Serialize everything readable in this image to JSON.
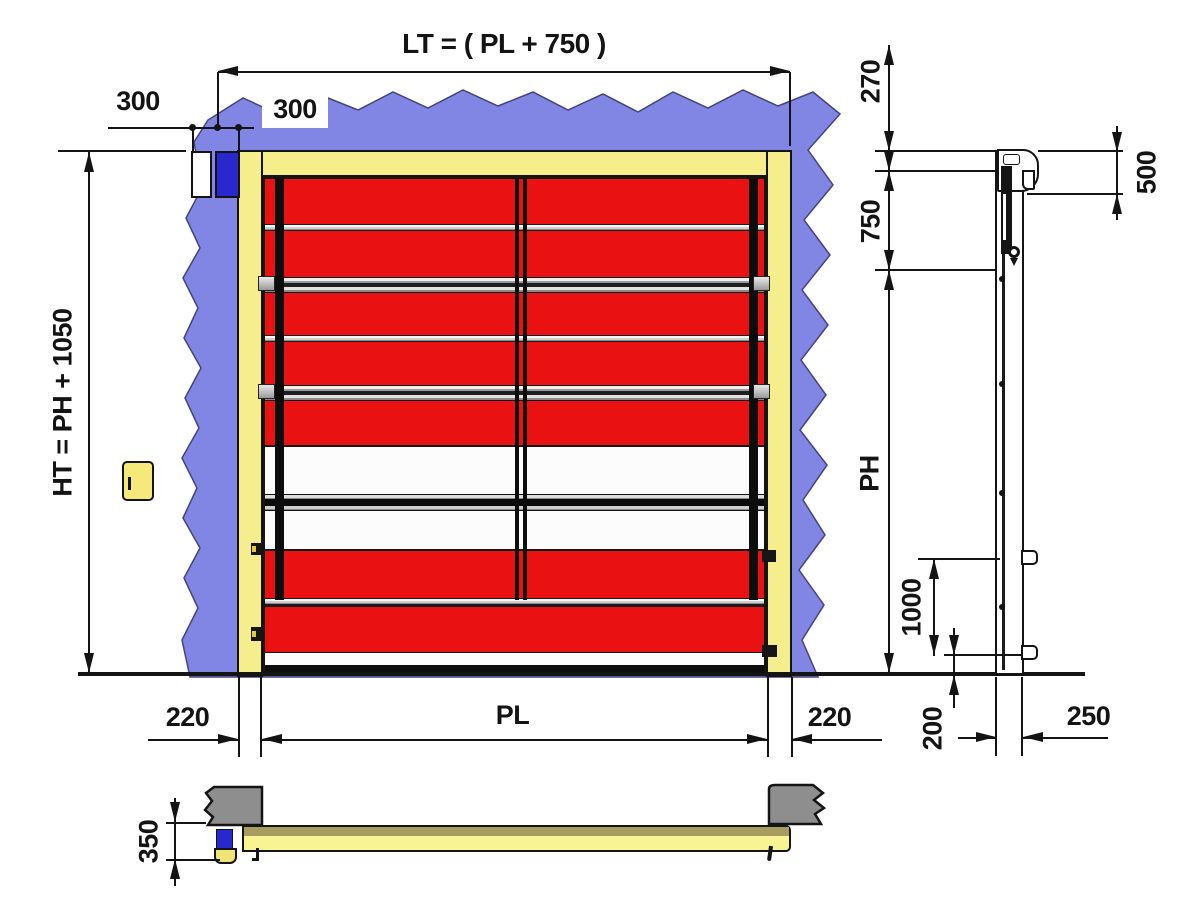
{
  "drawing": {
    "type": "technical-drawing",
    "views": {
      "front": "front elevation",
      "side": "side profile",
      "section": "bottom plan section"
    }
  },
  "colors": {
    "wall_blue": "#8186E4",
    "frame_yellow": "#F6EE8D",
    "curtain_red": "#E91111",
    "motor_blue": "#2828CC",
    "masonry_gray": "#8E8E8E",
    "metal_silver": "#C9C9C9",
    "section_bar_top": "#A89D60",
    "section_bar_body": "#F8F494",
    "line": "#141414"
  },
  "front": {
    "lt": "LT = ( PL + 750 )",
    "w300_left": "300",
    "w300_right": "300",
    "ht": "HT = PH + 1050",
    "b220_left": "220",
    "pl": "PL",
    "b220_right": "220"
  },
  "side": {
    "d270": "270",
    "d750": "750",
    "d500": "500",
    "ph": "PH",
    "d1000": "1000",
    "d200": "200",
    "d250": "250"
  },
  "section": {
    "d350": "350"
  }
}
